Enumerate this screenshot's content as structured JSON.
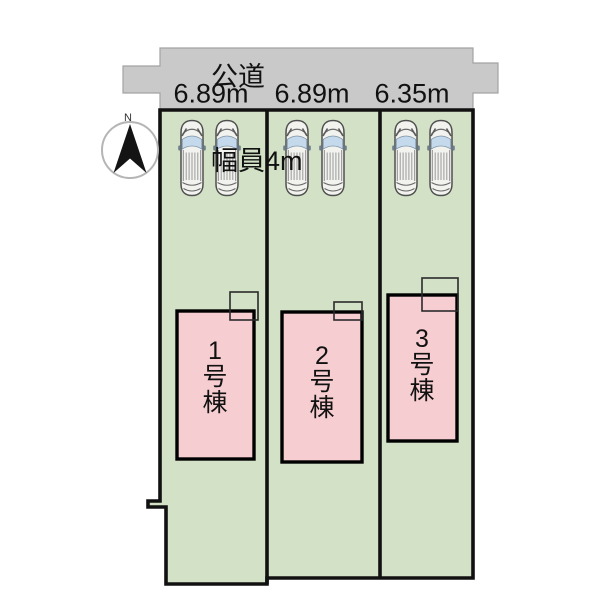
{
  "diagram": {
    "road": {
      "name_label": "公道",
      "width_label": "幅員4m"
    },
    "compass": {
      "north_label": "N"
    },
    "lots": [
      {
        "frontage_label": "6.89m",
        "building_label": "1号棟"
      },
      {
        "frontage_label": "6.89m",
        "building_label": "2号棟"
      },
      {
        "frontage_label": "6.35m",
        "building_label": "3号棟"
      }
    ],
    "colors": {
      "road_fill": "#c9c9c9",
      "lot_fill": "#d3e2c7",
      "building_fill": "#f6cdd1",
      "car_body": "#f2f3ef",
      "car_window": "#c4d9ec"
    }
  }
}
